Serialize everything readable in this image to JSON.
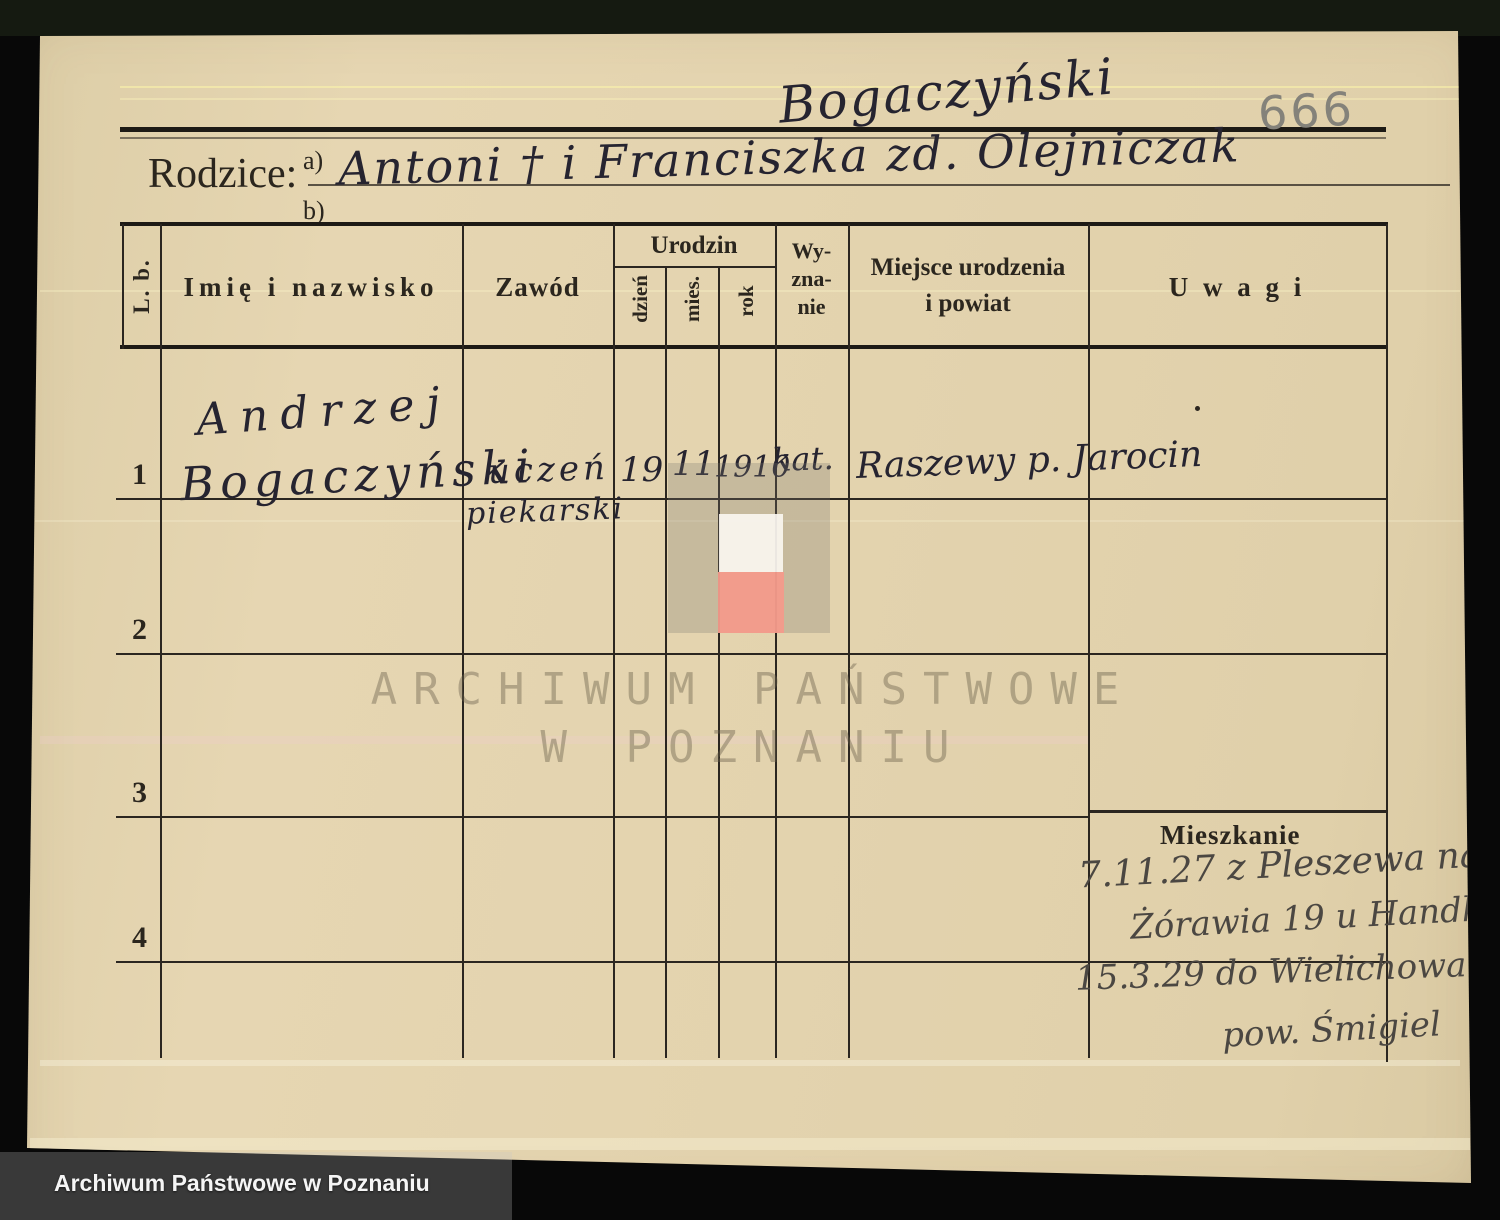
{
  "document": {
    "archive_number": "666",
    "surname_header": "Bogaczyński",
    "parents": {
      "label": "Rodzice:",
      "line_a_label": "a)",
      "line_b_label": "b)",
      "value": "Antoni † i Franciszka zd. Olejniczak"
    }
  },
  "table": {
    "headers": {
      "lb": "L. b.",
      "name": "Imię i nazwisko",
      "occupation": "Zawód",
      "birth_group": "Urodzin",
      "birth_day": "dzień",
      "birth_month": "mies.",
      "birth_year": "rok",
      "religion_line1": "Wy-",
      "religion_line2": "zna-",
      "religion_line3": "nie",
      "birthplace_line1": "Miejsce urodzenia",
      "birthplace_line2": "i powiat",
      "remarks": "U w a g i"
    },
    "rows": [
      {
        "number": "1",
        "name_line1": "Andrzej",
        "name_line2": "Bogaczyński",
        "occupation_line1": "uczeń",
        "occupation_line2": "piekarski",
        "birth_day": "19",
        "birth_month": "11",
        "birth_year": "1910",
        "religion": "kat.",
        "birthplace": "Raszewy p. Jarocin"
      },
      {
        "number": "2"
      },
      {
        "number": "3"
      },
      {
        "number": "4"
      }
    ]
  },
  "residence": {
    "label": "Mieszkanie",
    "lines": [
      "7.11.27 z Pleszewa na",
      "Żórawia 19 u Handke",
      "15.3.29 do Wielichowa",
      "pow. Śmigiel"
    ]
  },
  "watermark": {
    "line1": "ARCHIWUM PAŃSTWOWE",
    "line2": "W POZNANIU"
  },
  "footer": {
    "caption": "Archiwum Państwowe w Poznaniu"
  },
  "colors": {
    "paper": "#e3d3ae",
    "ink_printed": "#2b261e",
    "ink_handwriting": "#262430",
    "pencil_gray": "#84827a",
    "overlay_red": "#f49a8b",
    "watermark": "#69604a",
    "background": "#080808"
  }
}
